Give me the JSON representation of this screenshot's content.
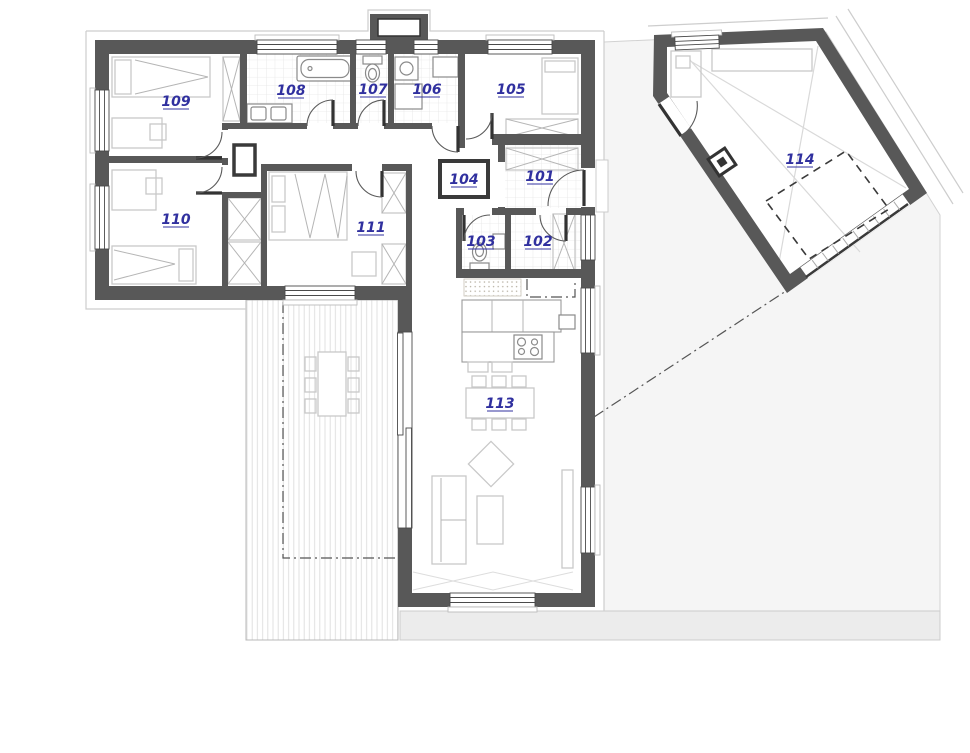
{
  "page": {
    "width": 970,
    "height": 753,
    "background": "#ffffff"
  },
  "plan": {
    "type": "architectural-floor-plan",
    "colors": {
      "wall": "#585858",
      "label": "#30309f",
      "furniture_outline": "#c8c8c8",
      "fixture_outline": "#8a8a8a",
      "yard": "#f5f5f5",
      "paving": "#ececec"
    },
    "rooms": [
      {
        "id": "101",
        "label": "101"
      },
      {
        "id": "102",
        "label": "102"
      },
      {
        "id": "103",
        "label": "103"
      },
      {
        "id": "104",
        "label": "104"
      },
      {
        "id": "105",
        "label": "105"
      },
      {
        "id": "106",
        "label": "106"
      },
      {
        "id": "107",
        "label": "107"
      },
      {
        "id": "108",
        "label": "108"
      },
      {
        "id": "109",
        "label": "109"
      },
      {
        "id": "110",
        "label": "110"
      },
      {
        "id": "111",
        "label": "111"
      },
      {
        "id": "113",
        "label": "113"
      },
      {
        "id": "114",
        "label": "114"
      }
    ]
  }
}
